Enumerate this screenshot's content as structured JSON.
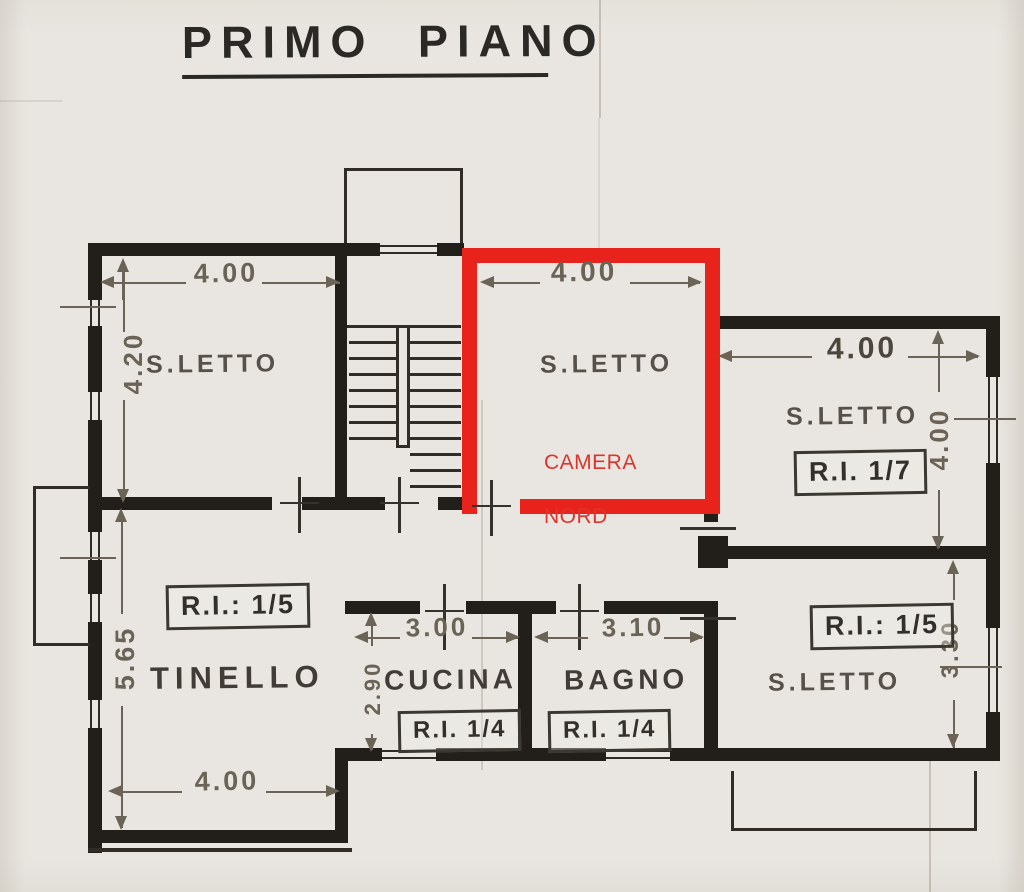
{
  "title": "PRIMO PIANO",
  "rooms": {
    "nw_bedroom": {
      "label": "S.LETTO",
      "dim_width": "4.00",
      "dim_height": "4.20"
    },
    "camera_nord": {
      "label": "S.LETTO",
      "dim_width": "4.00",
      "overlay_line1": "CAMERA",
      "overlay_line2": "NORD"
    },
    "ne_bedroom": {
      "label": "S.LETTO",
      "ref_code": "R.I. 1/7",
      "dim_width": "4.00",
      "dim_height": "4.00"
    },
    "se_bedroom": {
      "label": "S.LETTO",
      "ref_code": "R.I.: 1/5",
      "dim_height": "3.30"
    },
    "tinello": {
      "label": "TINELLO",
      "ref_code": "R.I.: 1/5",
      "dim_height": "5.65",
      "dim_width": "4.00"
    },
    "cucina": {
      "label": "CUCINA",
      "ref_code": "R.I. 1/4",
      "dim_width": "3.00",
      "dim_height": "2.90"
    },
    "bagno": {
      "label": "BAGNO",
      "ref_code": "R.I. 1/4",
      "dim_width": "3.10"
    }
  },
  "colors": {
    "highlight_wall": "#e8231c",
    "overlay_text": "#dd342d",
    "ink": "#221e19",
    "pencil": "#6a6356",
    "paper": "#e9e6e1"
  }
}
